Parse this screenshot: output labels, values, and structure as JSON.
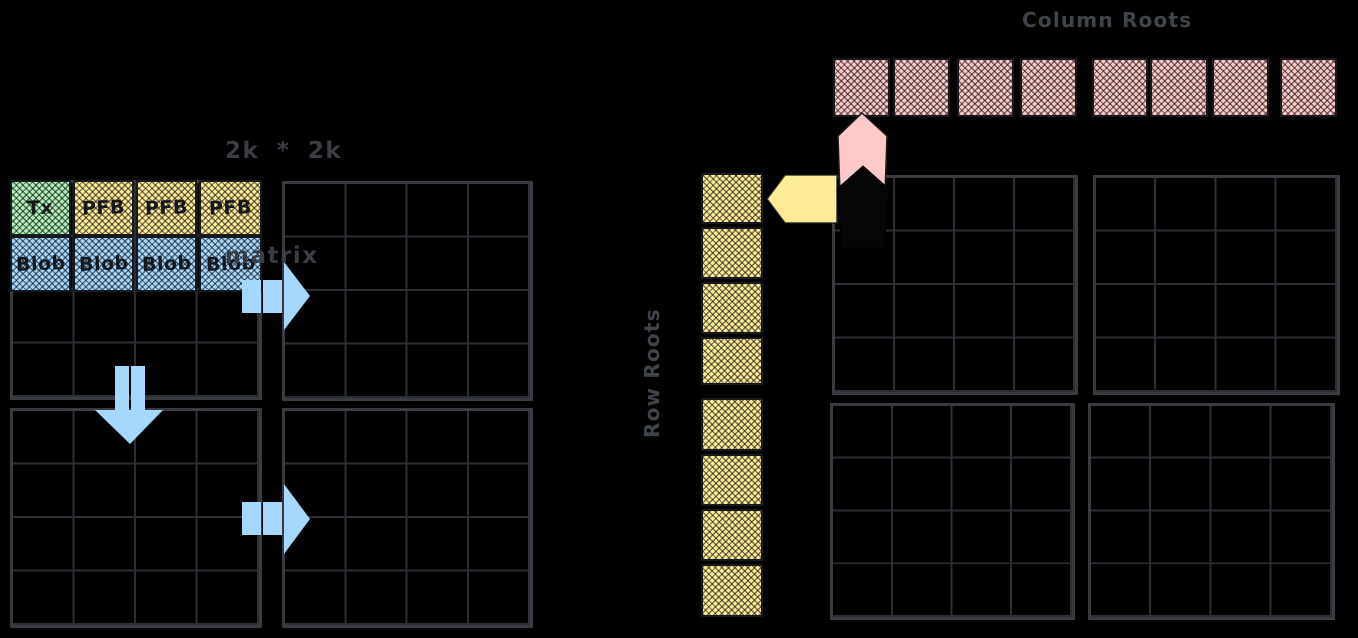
{
  "canvas": {
    "bg": "#000000"
  },
  "note": {
    "line1": "2k * 2k",
    "line2": "matrix"
  },
  "column_roots": {
    "label": "Column Roots",
    "cell_count": 8,
    "color": "#ffc9c9"
  },
  "row_roots": {
    "label": "Row Roots",
    "cell_count": 8,
    "color": "#ffec99"
  },
  "matrix_header": {
    "cells": [
      {
        "label": "Tx",
        "color": "#b2f2bb"
      },
      {
        "label": "PFB",
        "color": "#ffec99"
      },
      {
        "label": "PFB",
        "color": "#ffec99"
      },
      {
        "label": "PFB",
        "color": "#ffec99"
      },
      {
        "label": "Blob",
        "color": "#a5d8ff"
      },
      {
        "label": "Blob",
        "color": "#a5d8ff"
      },
      {
        "label": "Blob",
        "color": "#a5d8ff"
      }
    ]
  },
  "matrix_header_row2_last": {
    "label": "Blob",
    "color": "#a5d8ff"
  },
  "grid_layout": {
    "quadrant_grids": 8,
    "rows_per_grid": 4,
    "cols_per_grid": 4
  },
  "colors": {
    "grid_line": "#2b2e33",
    "grid_border": "#383b40",
    "stroke_dark": "#1e1e1e",
    "label_text": "#3f444b",
    "arrow_blue": "#a5d8ff",
    "arrow_pink": "#ffc9c9",
    "arrow_yellow": "#ffec99",
    "pentagon_black": "#060606"
  }
}
